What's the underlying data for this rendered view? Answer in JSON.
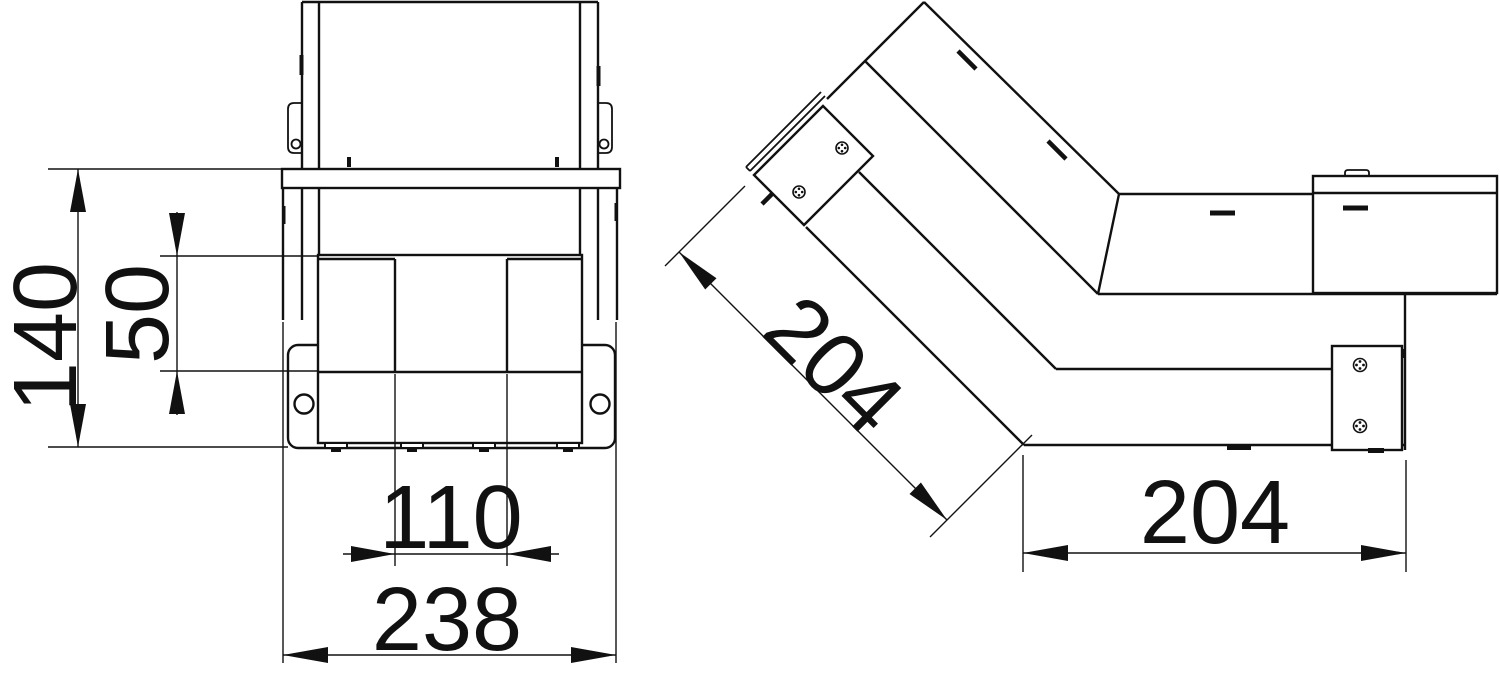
{
  "drawing": {
    "background": "#ffffff",
    "line_color": "#111111",
    "views": {
      "front": {
        "dimensions": {
          "overall_height": "140",
          "compartment_height": "50",
          "compartment_spacing": "110",
          "overall_width": "238"
        }
      },
      "side": {
        "dimensions": {
          "incline_length": "204",
          "horizontal_length": "204"
        }
      }
    }
  }
}
